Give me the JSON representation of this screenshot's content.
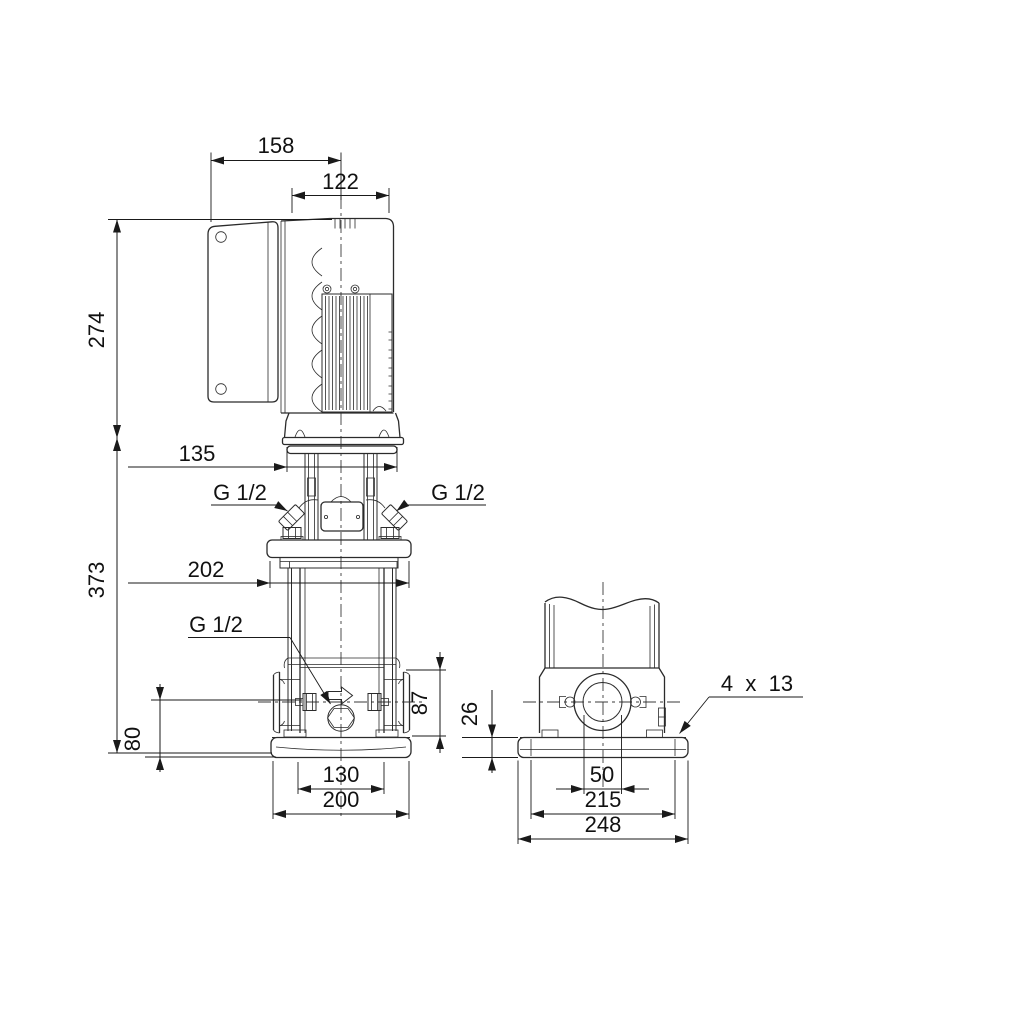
{
  "drawing": {
    "type": "pump dimensional drawing, two orthographic views",
    "front_view": {
      "total_width": "158",
      "motor_width": "122",
      "motor_height": "274",
      "pump_height": "373",
      "motor_flange_width": "135",
      "head_flange_width": "202",
      "port_face_height": "87",
      "port_center_height": "80",
      "foot_hole_span": "130",
      "base_width": "200",
      "gauge_port_left": "G 1/2",
      "gauge_port_right": "G 1/2",
      "drain_port": "G 1/2"
    },
    "side_view": {
      "base_thickness": "26",
      "base_holes": "4  x  13",
      "port_bore": "50",
      "bolt_hole_span": "215",
      "base_depth": "248"
    }
  }
}
